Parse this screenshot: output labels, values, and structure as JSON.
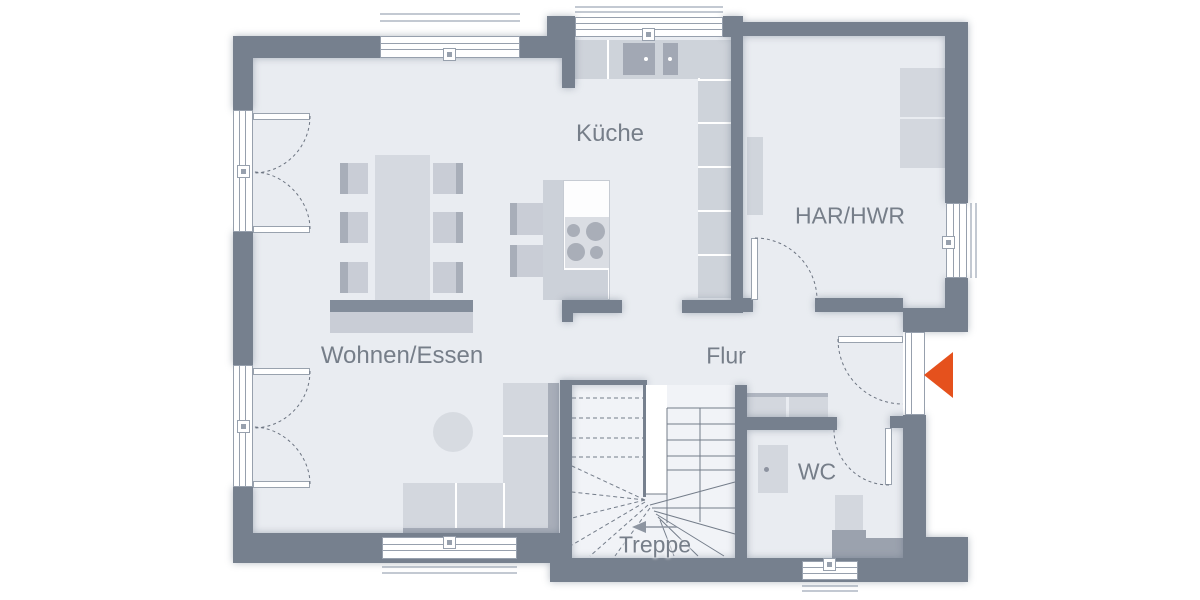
{
  "rooms": [
    {
      "key": "kueche",
      "label": "Küche"
    },
    {
      "key": "har_hwr",
      "label": "HAR/HWR"
    },
    {
      "key": "wohnen_essen",
      "label": "Wohnen/Essen"
    },
    {
      "key": "flur",
      "label": "Flur"
    },
    {
      "key": "wc",
      "label": "WC"
    },
    {
      "key": "treppe",
      "label": "Treppe"
    }
  ],
  "colors": {
    "wall": "#76808E",
    "floor": "#E9ECF1",
    "floor_stairs": "#F1F3F7",
    "furniture": "#D3D7DE",
    "furniture_mid": "#C9CDD6",
    "furniture_dark": "#A8AEB9",
    "frame": "#97A0AD",
    "line": "#6D7582",
    "label_text": "#767E89",
    "entrance_arrow": "#E5511D"
  }
}
